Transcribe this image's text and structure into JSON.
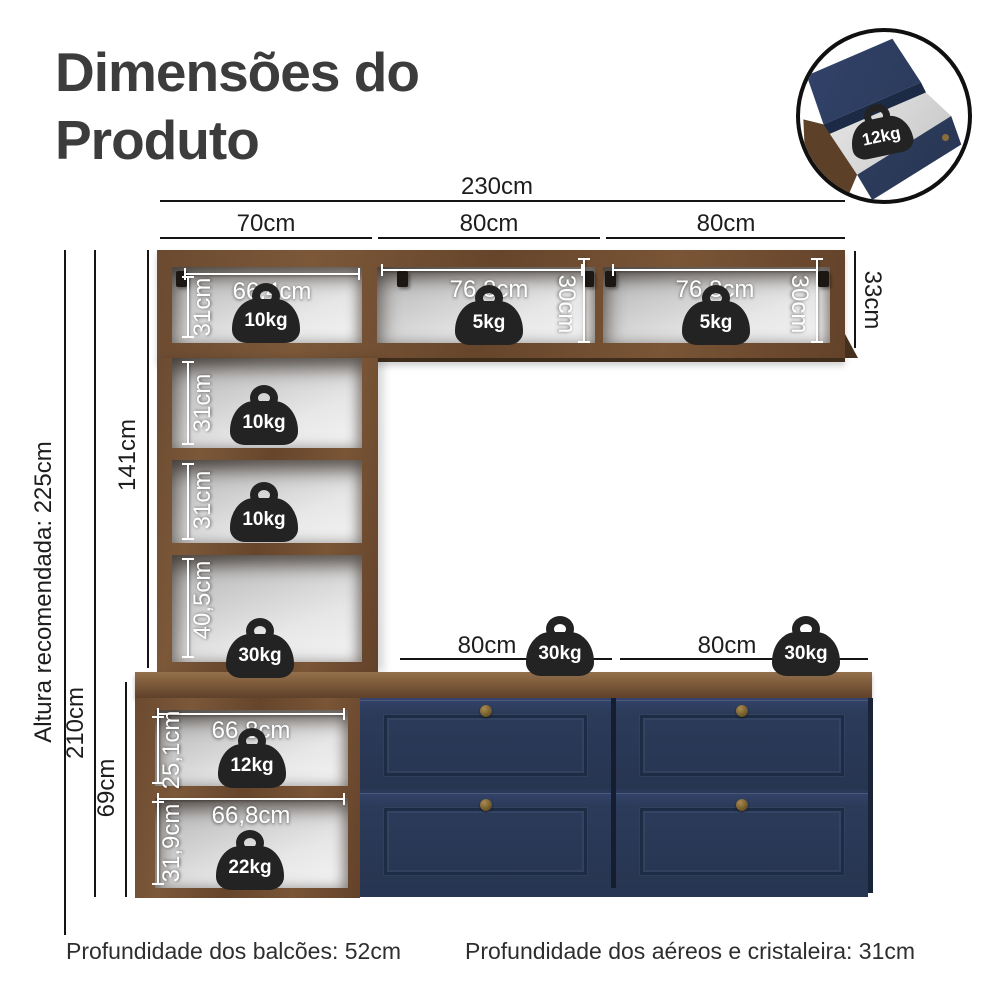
{
  "title": "Dimensões do Produto",
  "inset": {
    "load": "12kg"
  },
  "dims": {
    "total_width": "230cm",
    "col1": "70cm",
    "col2": "80cm",
    "col3": "80cm",
    "recommended_height": "Altura recomendada: 225cm",
    "total_height": "210cm",
    "tower_height": "141cm",
    "base_height": "69cm",
    "wall_height": "33cm"
  },
  "tower": {
    "shelf1": {
      "height": "31cm",
      "width": "66,4cm",
      "load": "10kg"
    },
    "shelf2": {
      "height": "31cm",
      "load": "10kg"
    },
    "shelf3": {
      "height": "31cm",
      "load": "10kg"
    },
    "shelf4": {
      "height": "40,5cm",
      "load": "30kg"
    }
  },
  "wall": {
    "mid": {
      "width": "76,8cm",
      "height": "30cm",
      "load": "5kg"
    },
    "right": {
      "width": "76,8cm",
      "height": "30cm",
      "load": "5kg"
    }
  },
  "base": {
    "span1": {
      "width": "80cm",
      "load": "30kg"
    },
    "span2": {
      "width": "80cm",
      "load": "30kg"
    },
    "shelf_top": {
      "height": "25,1cm",
      "width": "66,8cm",
      "load": "12kg"
    },
    "shelf_bottom": {
      "height": "31,9cm",
      "width": "66,8cm",
      "load": "22kg"
    }
  },
  "footnotes": {
    "balcoes": "Profundidade dos balcões: 52cm",
    "aereos": "Profundidade dos aéreos e cristaleira: 31cm"
  }
}
